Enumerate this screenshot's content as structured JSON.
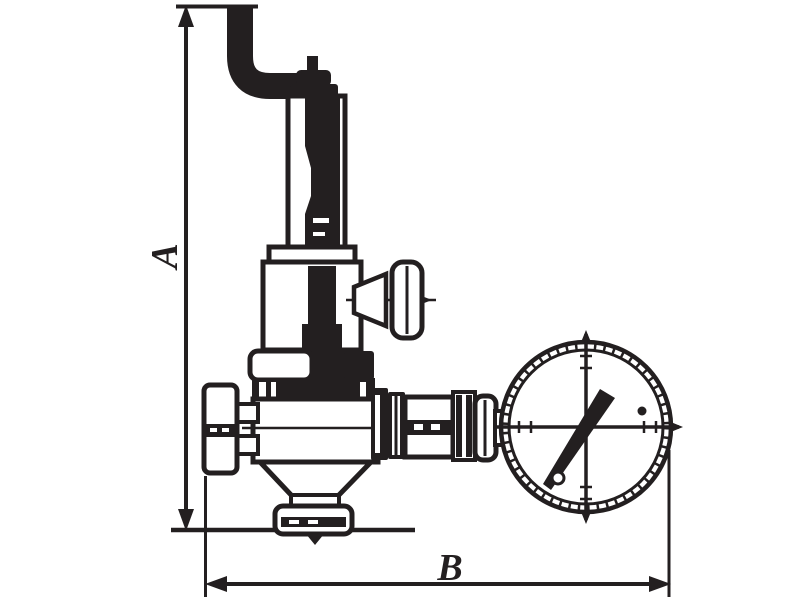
{
  "diagram": {
    "background": "#ffffff",
    "ink": "#231f20",
    "labels": {
      "dim_height": "A",
      "dim_width": "B"
    },
    "parts": [
      "supply-pipe-elbow",
      "adjusting-screw-tube",
      "spring-housing",
      "shutoff-t-handle",
      "valve-bonnet",
      "valve-body",
      "inlet-union-nut",
      "bottom-drain-nut",
      "outlet-coupling",
      "pressure-gauge"
    ]
  }
}
